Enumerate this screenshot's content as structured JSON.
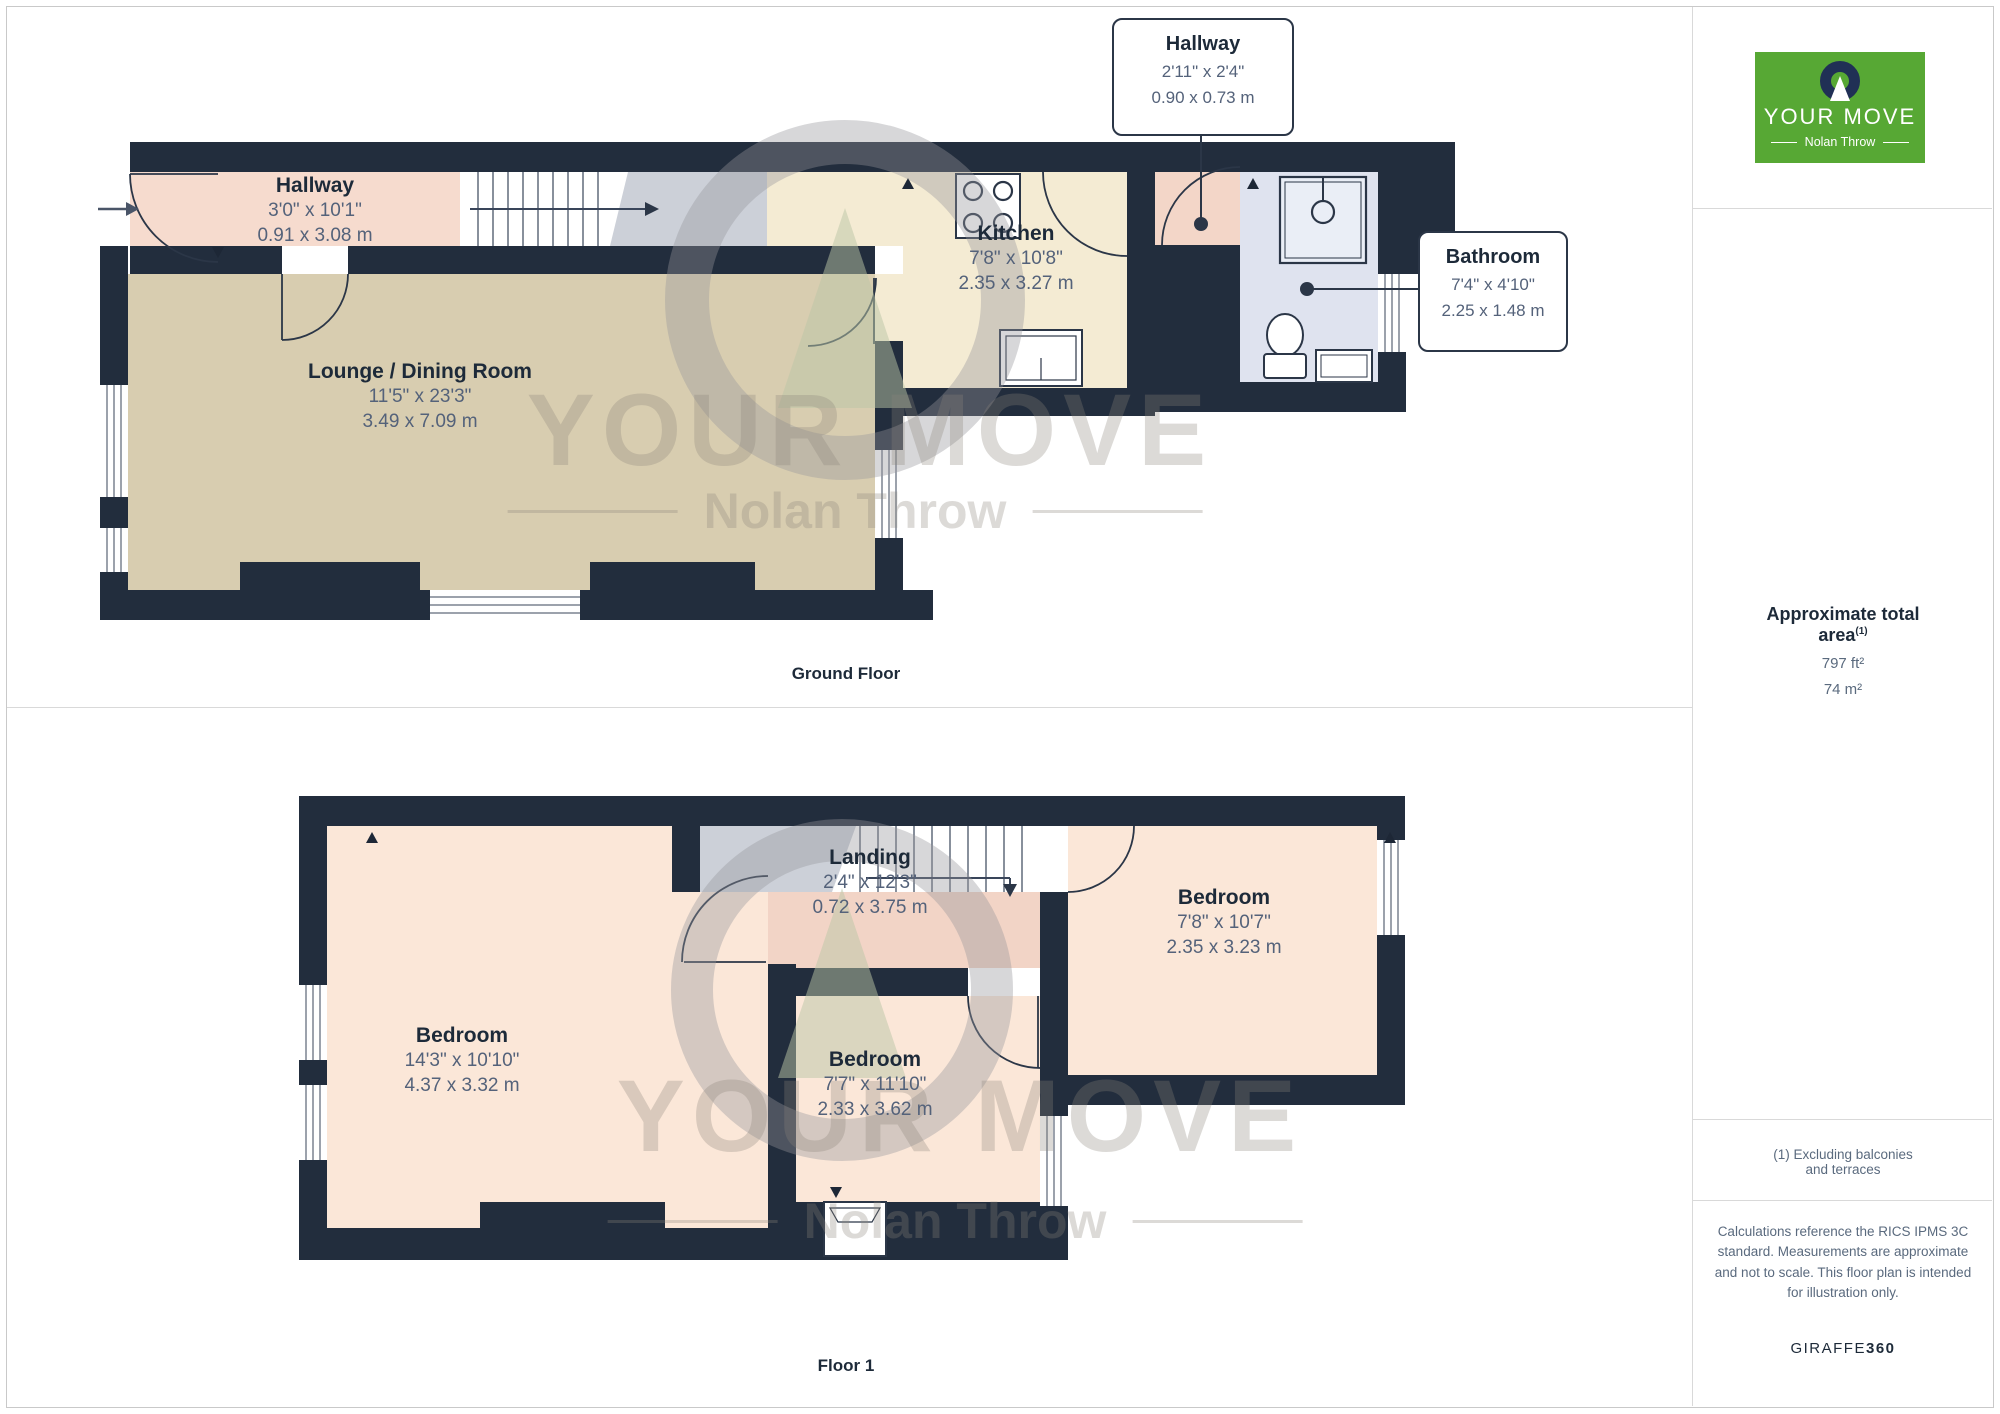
{
  "colors": {
    "wall": "#222d3d",
    "logo_green": "#57a834",
    "text_dark": "#1d2a39",
    "text_dim": "#54627a"
  },
  "ground_floor": {
    "caption": "Ground Floor",
    "hallway": {
      "name": "Hallway",
      "imperial": "3'0\" x 10'1\"",
      "metric": "0.91 x 3.08 m"
    },
    "lounge": {
      "name": "Lounge / Dining Room",
      "imperial": "11'5\" x 23'3\"",
      "metric": "3.49 x 7.09 m"
    },
    "kitchen": {
      "name": "Kitchen",
      "imperial": "7'8\" x 10'8\"",
      "metric": "2.35 x 3.27 m"
    },
    "hallway_callout": {
      "name": "Hallway",
      "imperial": "2'11\" x 2'4\"",
      "metric": "0.90 x 0.73 m"
    },
    "bathroom_callout": {
      "name": "Bathroom",
      "imperial": "7'4\" x 4'10\"",
      "metric": "2.25 x 1.48 m"
    }
  },
  "floor_1": {
    "caption": "Floor 1",
    "landing": {
      "name": "Landing",
      "imperial": "2'4\" x 12'3\"",
      "metric": "0.72 x 3.75 m"
    },
    "bedroom_left": {
      "name": "Bedroom",
      "imperial": "14'3\" x 10'10\"",
      "metric": "4.37 x 3.32 m"
    },
    "bedroom_middle": {
      "name": "Bedroom",
      "imperial": "7'7\" x 11'10\"",
      "metric": "2.33 x 3.62 m"
    },
    "bedroom_right": {
      "name": "Bedroom",
      "imperial": "7'8\" x 10'7\"",
      "metric": "2.35 x 3.23 m"
    }
  },
  "sidebar": {
    "logo": {
      "brand": "YOUR MOVE",
      "subbrand": "Nolan Throw"
    },
    "area_title": "Approximate total area",
    "area_superscript": "(1)",
    "area_ft": "797 ft²",
    "area_m": "74 m²",
    "footnote": "(1) Excluding balconies and terraces",
    "disclaimer": "Calculations reference the RICS IPMS 3C standard. Measurements are approximate and not to scale. This floor plan is intended for illustration only.",
    "credit_brand": "GIRAFFE",
    "credit_bold": "360"
  },
  "watermark": {
    "brand": "YOUR MOVE",
    "subbrand": "Nolan Throw"
  }
}
